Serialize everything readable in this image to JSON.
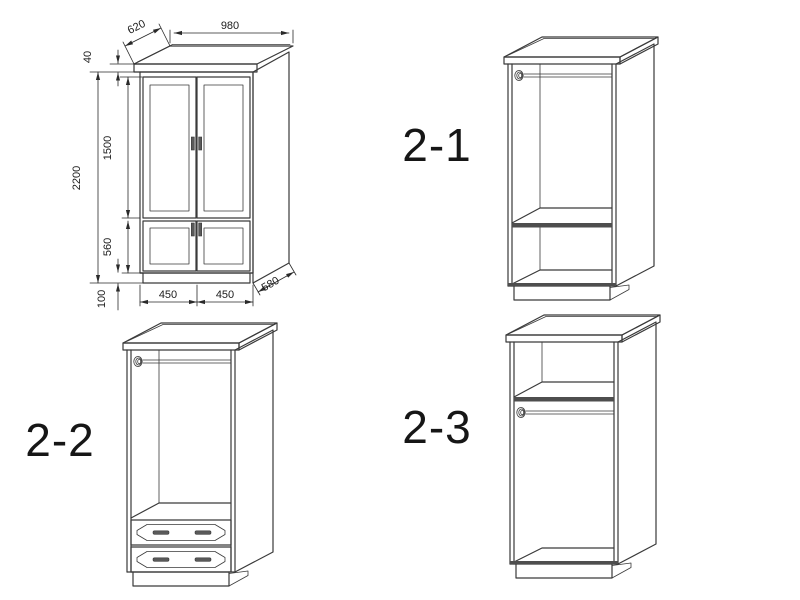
{
  "diagram": {
    "front_view": {
      "dimensions": {
        "top_width": "980",
        "top_depth": "620",
        "cornice_height": "40",
        "total_height": "2200",
        "upper_door_height": "1500",
        "lower_door_height": "560",
        "plinth_height": "100",
        "left_door_width": "450",
        "right_door_width": "450",
        "base_depth": "580"
      }
    },
    "views": {
      "top_right": {
        "label": "2-1"
      },
      "bottom_left": {
        "label": "2-2"
      },
      "bottom_right": {
        "label": "2-3"
      }
    },
    "colors": {
      "line": "#3a3a3a",
      "dimension_line": "#2a2a2a",
      "text": "#1c1c1c",
      "background": "#ffffff"
    }
  }
}
